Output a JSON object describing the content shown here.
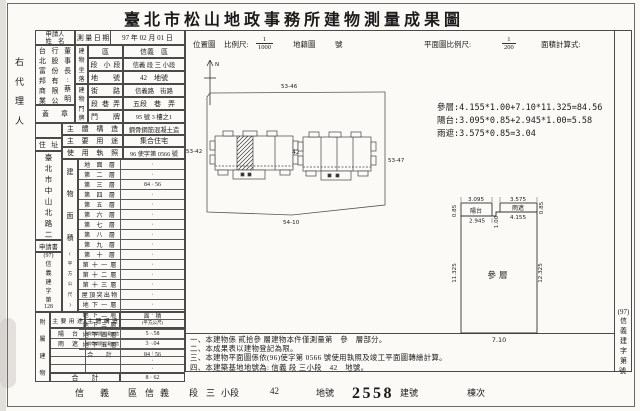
{
  "page": {
    "title": "臺北市松山地政事務所建物測量成果圖",
    "left_agent": "右代理人",
    "office_case_note": "申請書"
  },
  "applicant": {
    "header_line1": "申請人",
    "header_line2": "姓　名",
    "name_cols": [
      "台北富邦商業銀",
      "行股份有限公司",
      "董事長:蔡明忠"
    ],
    "seal": "蓋章"
  },
  "fields": {
    "survey_date_label": "測量日期",
    "survey_date": "97 年 02 月 01 日",
    "location_label": "建物坐落",
    "location_rows": [
      {
        "label": "區",
        "value": "信義　區"
      },
      {
        "label": "段 小段",
        "value": "信義 段 三 小段"
      },
      {
        "label": "地　號",
        "value": "42　地號"
      }
    ],
    "door_label": "建物門牌",
    "door_rows": [
      {
        "label": "街　路",
        "value": "信義路　街路"
      },
      {
        "label": "段巷弄",
        "value": "五段　巷　弄"
      },
      {
        "label": "門　牌",
        "value": "95 號 3 樓之1"
      }
    ],
    "structure_label": "主體構造",
    "structure_value": "鋼骨鋼筋混凝土造",
    "use_label": "主要用途",
    "use_value": "集合住宅",
    "license_label": "使用執照",
    "license_value": "96 使字第 0566 號"
  },
  "address_col": {
    "header": "住址",
    "address_items": [
      "臺",
      "北",
      "市",
      "中",
      "山",
      "北",
      "路",
      "二",
      "段",
      "50",
      "號"
    ],
    "app_header": "申請書",
    "case_items": [
      "(97)",
      "信",
      "義",
      "建",
      "字",
      "第",
      "128",
      "號"
    ]
  },
  "floor_table": {
    "side_label": "建物面積",
    "side_unit": "(平方公尺)",
    "rows": [
      {
        "label": "地面層",
        "value": "·"
      },
      {
        "label": "第二層",
        "value": "·"
      },
      {
        "label": "第三層",
        "value": "84 · 56"
      },
      {
        "label": "第四層",
        "value": "·"
      },
      {
        "label": "第五層",
        "value": "·"
      },
      {
        "label": "第六層",
        "value": "·"
      },
      {
        "label": "第七層",
        "value": "·"
      },
      {
        "label": "第八層",
        "value": "·"
      },
      {
        "label": "第九層",
        "value": "·"
      },
      {
        "label": "第十層",
        "value": "·"
      },
      {
        "label": "第十一層",
        "value": "·"
      },
      {
        "label": "第十二層",
        "value": "·"
      },
      {
        "label": "第十三層",
        "value": "·"
      },
      {
        "label": "屋頂突出物",
        "value": "·"
      },
      {
        "label": "地下一層",
        "value": "·"
      },
      {
        "label": "地下二層",
        "value": "·"
      },
      {
        "label": "地下三層",
        "value": "·"
      },
      {
        "label": "地下四層",
        "value": "·"
      },
      {
        "label": "地下五層",
        "value": "·"
      },
      {
        "label": "合計",
        "value": "84 · 56"
      }
    ]
  },
  "annex_table": {
    "side_label": "附屬建物",
    "use_header": "主要用途",
    "structure_header": "主體構造",
    "area_header": "面積",
    "area_unit": "(平方公尺)",
    "rows": [
      {
        "use": "陽台",
        "structure": "鋼骨鋼筋混凝土造",
        "area": "5 · 58"
      },
      {
        "use": "雨遮",
        "structure": "鋼骨鋼筋混凝土造",
        "area": "3 · 04"
      },
      {
        "use": "",
        "structure": "",
        "area": "·"
      },
      {
        "use": "",
        "structure": "",
        "area": "·"
      },
      {
        "use": "",
        "structure": "",
        "area": "·"
      }
    ],
    "total_label": "合計",
    "total_value": "8 · 62"
  },
  "site_plan": {
    "title": "位置圖",
    "scale_label": "比例尺:",
    "scale_num": "1",
    "scale_den": "1000",
    "cadastre_label": "地籍圖",
    "sheet_label": "號",
    "north_label": "N",
    "boundary_top": "53-46",
    "boundary_left": "53-42",
    "boundary_right": "53-47",
    "boundary_bottom": "54-10",
    "lot_label": "42"
  },
  "floor_plan": {
    "title": "平面圖比例尺:",
    "scale_num": "1",
    "scale_den": "200",
    "calc_label": "面積計算式:",
    "calculations": [
      "參層:4.155*1.00+7.10*11.325=84.56",
      "陽台:3.095*0.85+2.945*1.00=5.58",
      "雨遮:3.575*0.85=3.04"
    ],
    "room_label": "參層",
    "balcony_label": "陽台",
    "canopy_label": "雨遮",
    "dims": {
      "balcony_w": "3.095",
      "balcony_d": "0.85",
      "balcony_inner": "2.945",
      "step_h": "1.00",
      "canopy_w": "3.575",
      "canopy_d": "0.85",
      "canopy_inner": "4.155",
      "height_left": "11.325",
      "height_right": "12.325",
      "width_bottom": "7.10"
    }
  },
  "notes": [
    "一、本建物係 貳拾參 層建物本件僅測量第　參　層部分。",
    "二、本成果表以建物登記為限。",
    "三、本建物平面圖係依(96)使字第 0566 號使用執照及竣工平面圖轉繪計算。",
    "四、本建築基地地號為: 信義 段 三小段　42　地號。"
  ],
  "right_edge": {
    "items": [
      "(97)",
      "信",
      "義",
      "建",
      "字",
      "第"
    ],
    "suffix": "號"
  },
  "footer": {
    "segments": [
      {
        "t": "信",
        "x": 75
      },
      {
        "t": "義",
        "x": 100
      },
      {
        "t": "區",
        "x": 128
      },
      {
        "t": "信",
        "x": 145
      },
      {
        "t": "義",
        "x": 160
      },
      {
        "t": "段",
        "x": 189
      },
      {
        "t": "三",
        "x": 206
      },
      {
        "t": "小段",
        "x": 221
      },
      {
        "t": "42",
        "x": 270
      },
      {
        "t": "地號",
        "x": 316
      },
      {
        "t": "建號",
        "x": 400
      },
      {
        "t": "棟次",
        "x": 467
      }
    ],
    "stamp": "2558"
  }
}
